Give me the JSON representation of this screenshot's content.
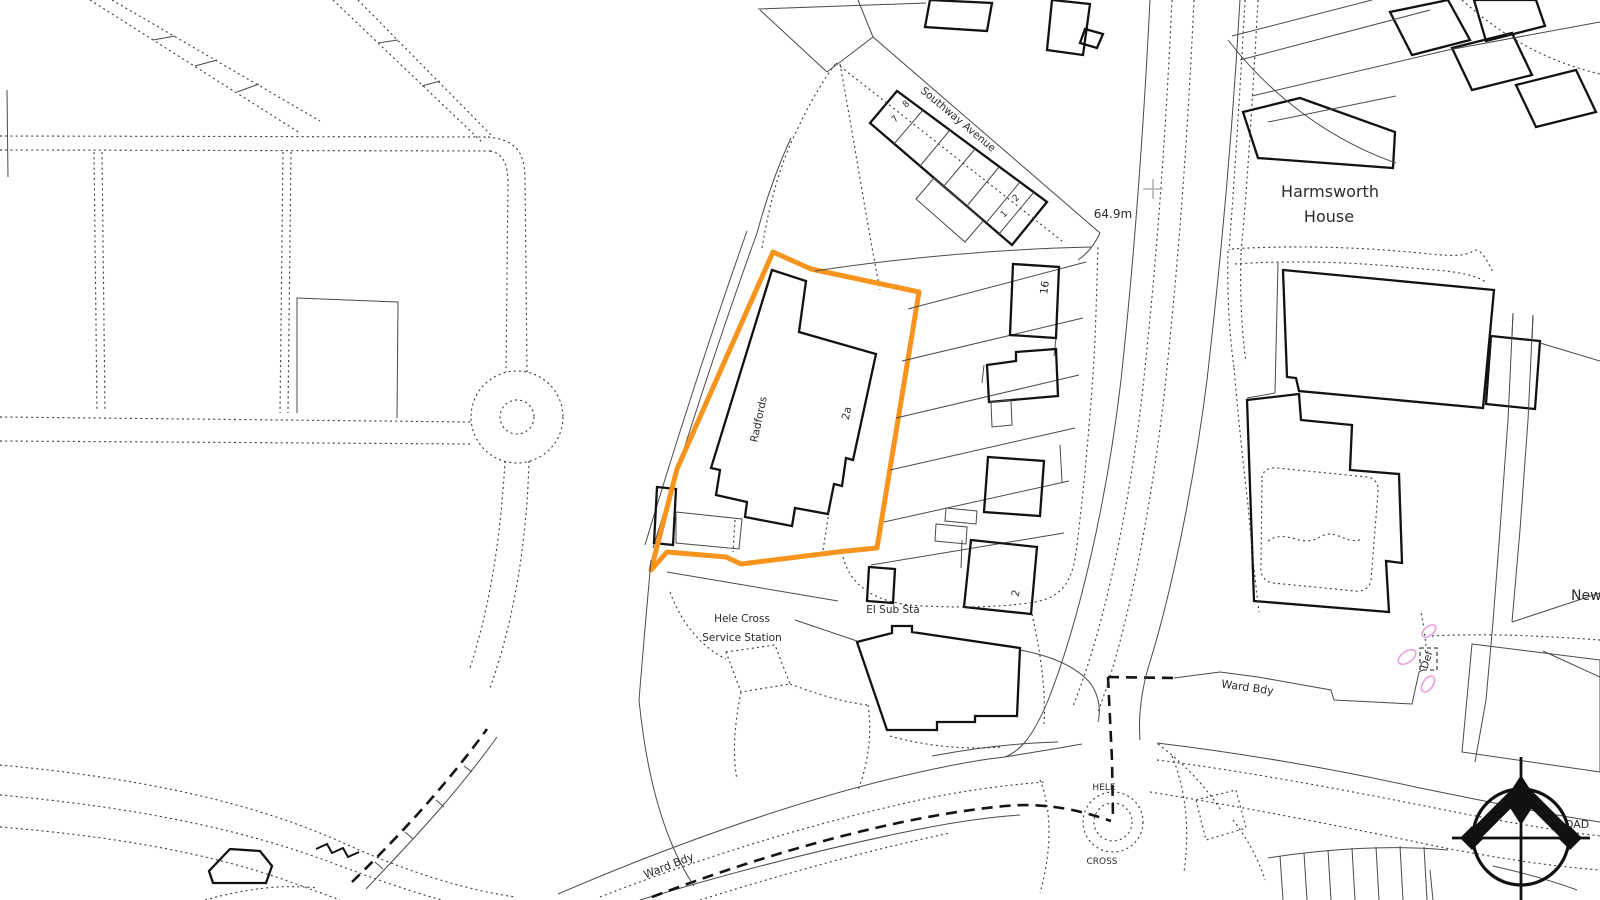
{
  "map": {
    "colors": {
      "site_boundary": "#f7941e",
      "boundary_marker_pink": "#eba2dc",
      "grid_mark_gray": "#b2b2b2",
      "linework": "#3f3f3f"
    },
    "labels": {
      "street": "Southway Avenue",
      "spot_height": "64.9m",
      "house_name_1": "Harmsworth",
      "house_name_2": "House",
      "site_building": "Radfords",
      "site_number": "2a",
      "terrace_no_8": "8",
      "terrace_no_7": "7",
      "terrace_no_2": "2",
      "terrace_no_1": "1",
      "building_no_16": "16",
      "building_no_2": "2",
      "substation": "El Sub Sta",
      "service_station_1": "Hele Cross",
      "service_station_2": "Service Station",
      "ward_boundary_east": "Ward Bdy",
      "ward_boundary_south": "Ward Bdy",
      "junction_name_1": "HELE",
      "junction_name_2": "CROSS",
      "boundary_def": "Def",
      "road_name_partial_new": "New",
      "road_name_fragment_left": "er",
      "road_name_fragment_right": "OAD"
    }
  }
}
